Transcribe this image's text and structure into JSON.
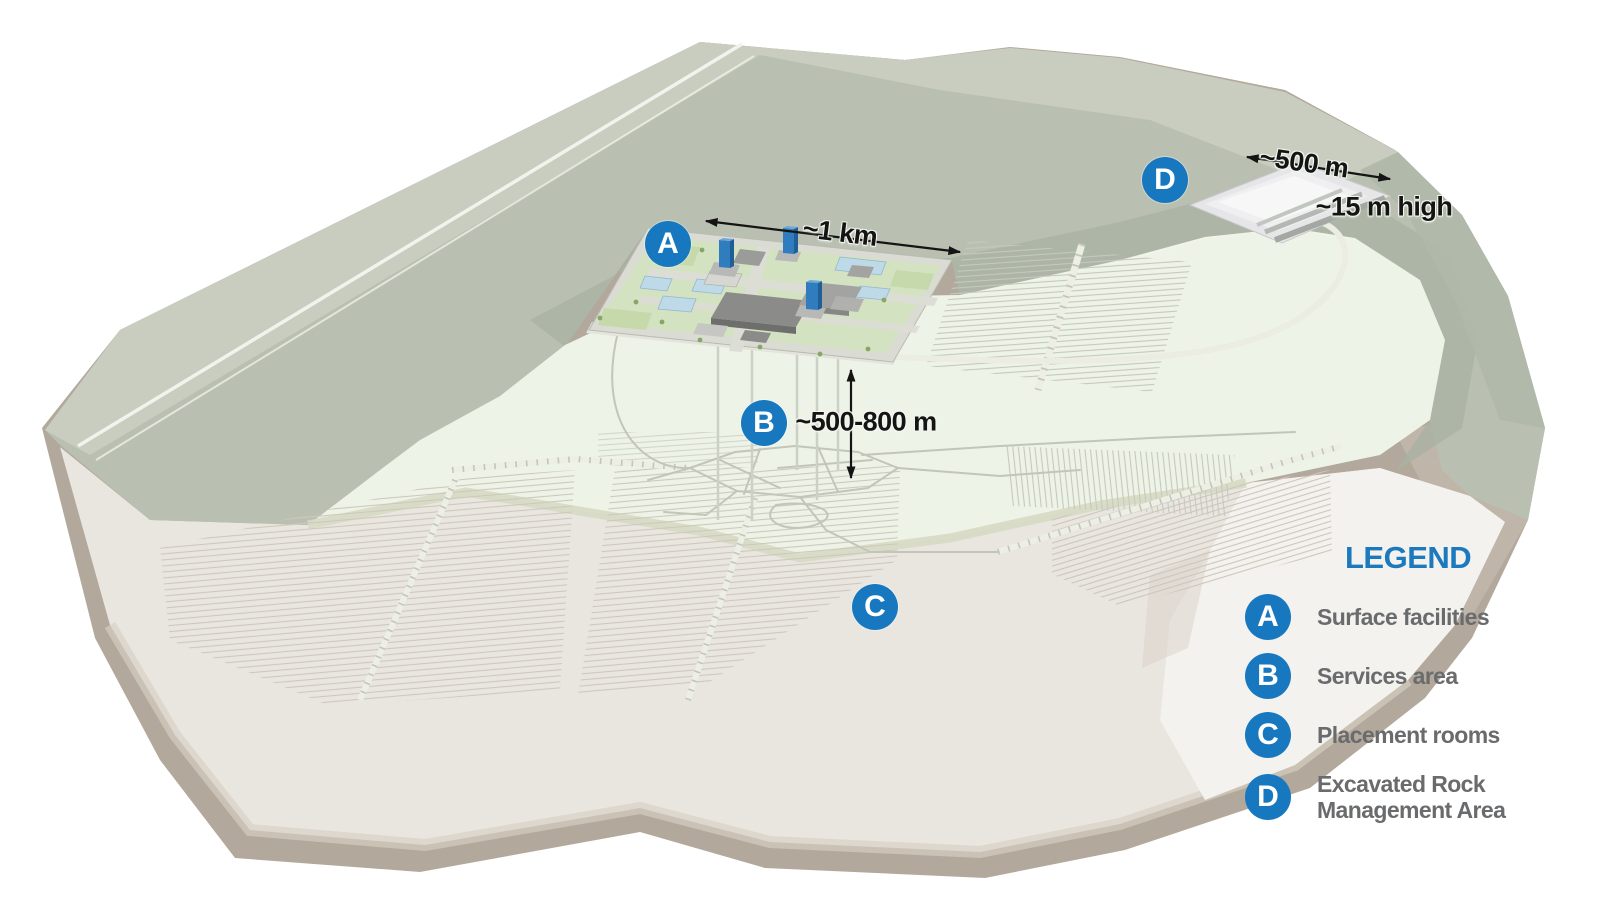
{
  "markers": [
    {
      "letter": "A"
    },
    {
      "letter": "B"
    },
    {
      "letter": "C"
    },
    {
      "letter": "D"
    }
  ],
  "annotations": {
    "surface_width": "~1 km",
    "depth": "~500-800 m",
    "rock_area_width": "~500 m",
    "rock_area_height": "~15 m high"
  },
  "legend": {
    "title": "LEGEND",
    "items": [
      {
        "letter": "A",
        "label": "Surface facilities"
      },
      {
        "letter": "B",
        "label": "Services area"
      },
      {
        "letter": "C",
        "label": "Placement rooms"
      },
      {
        "letter": "D",
        "label": "Excavated Rock",
        "label2": "Management Area"
      }
    ]
  },
  "colors": {
    "marker_blue": "#1878bf",
    "legend_title_blue": "#1b79bd",
    "legend_text_gray": "#6a6b6d",
    "hills_green": "#b9c0b2",
    "plain_green": "#edf3e7",
    "rock_top_beige": "#e9e5df",
    "rock_side_taupe": "#b3a89c"
  }
}
